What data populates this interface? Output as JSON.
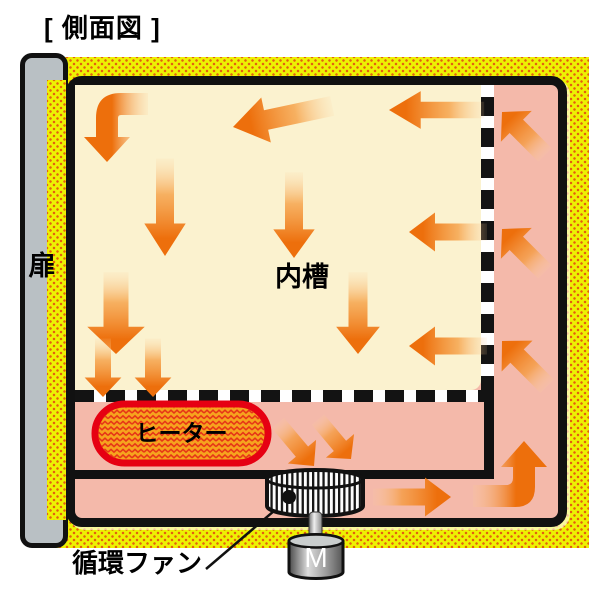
{
  "title": "[ 側面図 ]",
  "labels": {
    "door": "扉",
    "inner_chamber": "内槽",
    "heater": "ヒーター",
    "motor": "M",
    "circulation_fan": "循環ファン"
  },
  "colors": {
    "insulation_yellow": "#edf103",
    "insulation_dot_orange": "#e55f10",
    "duct_pink": "#f4b9aa",
    "chamber_cream": "#fbf2cf",
    "arrow_orange": "#ed6f0c",
    "heater_fill_orange": "#f6a41e",
    "heater_border_red": "#e60012",
    "door_gray": "#b9c0c4",
    "outline_black": "#111111"
  }
}
